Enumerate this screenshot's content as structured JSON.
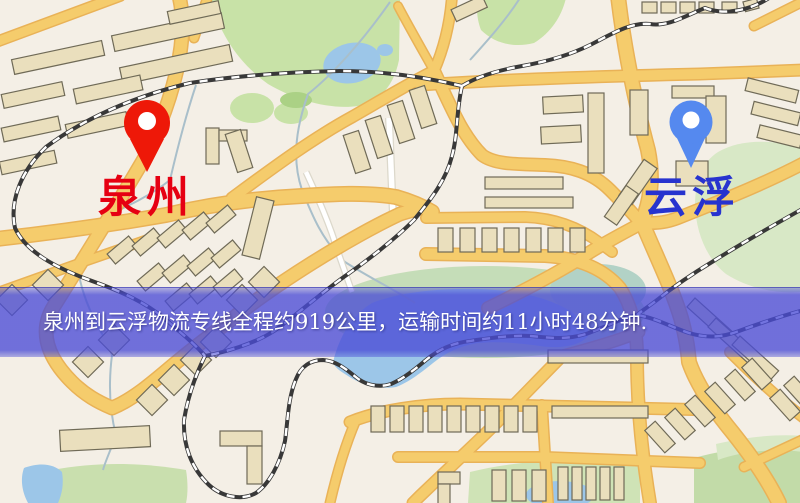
{
  "map": {
    "type": "logistics-route-map",
    "markers": [
      {
        "id": "quanzhou",
        "label": "泉州",
        "pin_color": "#ee1808",
        "pin_stroke": "#c31105",
        "label_color": "#e60012",
        "pin_style": "red-teardrop"
      },
      {
        "id": "yunfu",
        "label": "云浮",
        "pin_color": "#5589ef",
        "pin_stroke": "#3d6fd6",
        "label_color": "#2733cf",
        "pin_style": "blue-teardrop"
      }
    ],
    "banner": {
      "text": "泉州到云浮物流专线全程约919公里，运输时间约11小时48分钟.",
      "overlay_color": "#4a4cd6",
      "text_color": "#ffffff"
    },
    "route": {
      "origin": "泉州",
      "destination": "云浮",
      "distance": "约919公里",
      "duration": "约11小时48分钟"
    },
    "palette": {
      "background": "#f4efe6",
      "road_major": "#f5cc6c",
      "road_casing": "#e9b257",
      "road_minor": "#ffffff",
      "road_minor_casing": "#dcd8cb",
      "building": "#eadfbd",
      "building_outline": "#6f6a57",
      "park": "#c8e2a7",
      "park_light": "#d8e8c6",
      "marsh": "#c0dab2",
      "water": "#9cc6e8",
      "stream": "#a9bfca",
      "railway_dark": "#383838",
      "railway_light": "#ffffff"
    }
  }
}
